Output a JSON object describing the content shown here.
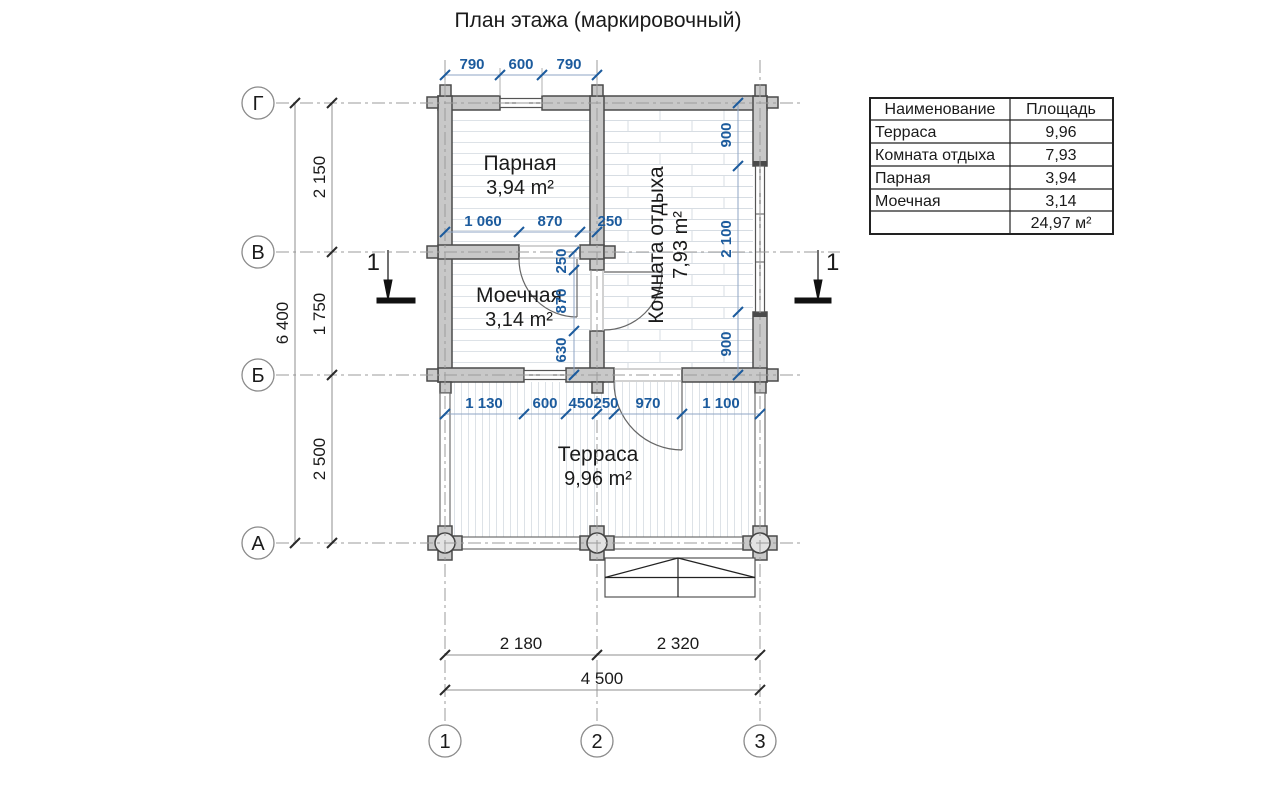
{
  "title": "План этажа (маркировочный)",
  "legend_table": {
    "headers": [
      "Наименование",
      "Площадь"
    ],
    "rows": [
      {
        "name": "Терраса",
        "area": "9,96"
      },
      {
        "name": "Комната отдыха",
        "area": "7,93"
      },
      {
        "name": "Парная",
        "area": "3,94"
      },
      {
        "name": "Моечная",
        "area": "3,14"
      }
    ],
    "total": "24,97 м²"
  },
  "grid_axes": {
    "rows": [
      "Г",
      "В",
      "Б",
      "А"
    ],
    "columns": [
      "1",
      "2",
      "3"
    ]
  },
  "rooms": {
    "parnaya": {
      "name": "Парная",
      "area": "3,94 m²"
    },
    "moechnaya": {
      "name": "Моечная",
      "area": "3,14 m²"
    },
    "komnata": {
      "name": "Комната отдыха",
      "area": "7,93 m²"
    },
    "terrasa": {
      "name": "Терраса",
      "area": "9,96 m²"
    }
  },
  "dimensions": {
    "top_chain": [
      "790",
      "600",
      "790"
    ],
    "left_chain": [
      "2 150",
      "1 750",
      "2 500"
    ],
    "left_overall": "6 400",
    "bottom_chain": [
      "2 180",
      "2 320"
    ],
    "bottom_overall": "4 500",
    "parnaya_chain": [
      "1 060",
      "870",
      "250"
    ],
    "axis2_chain": [
      "250",
      "870",
      "630"
    ],
    "right_inner_chain": [
      "900",
      "2 100",
      "900"
    ],
    "terrace_chain": [
      "1 130",
      "600",
      "450",
      "250",
      "970",
      "1 100"
    ]
  },
  "section_mark": {
    "label": "1"
  },
  "colors": {
    "dim_blue": "#1c5b9d",
    "wall_fill": "#c8c8c8",
    "line_dark": "#4a4a4a"
  }
}
